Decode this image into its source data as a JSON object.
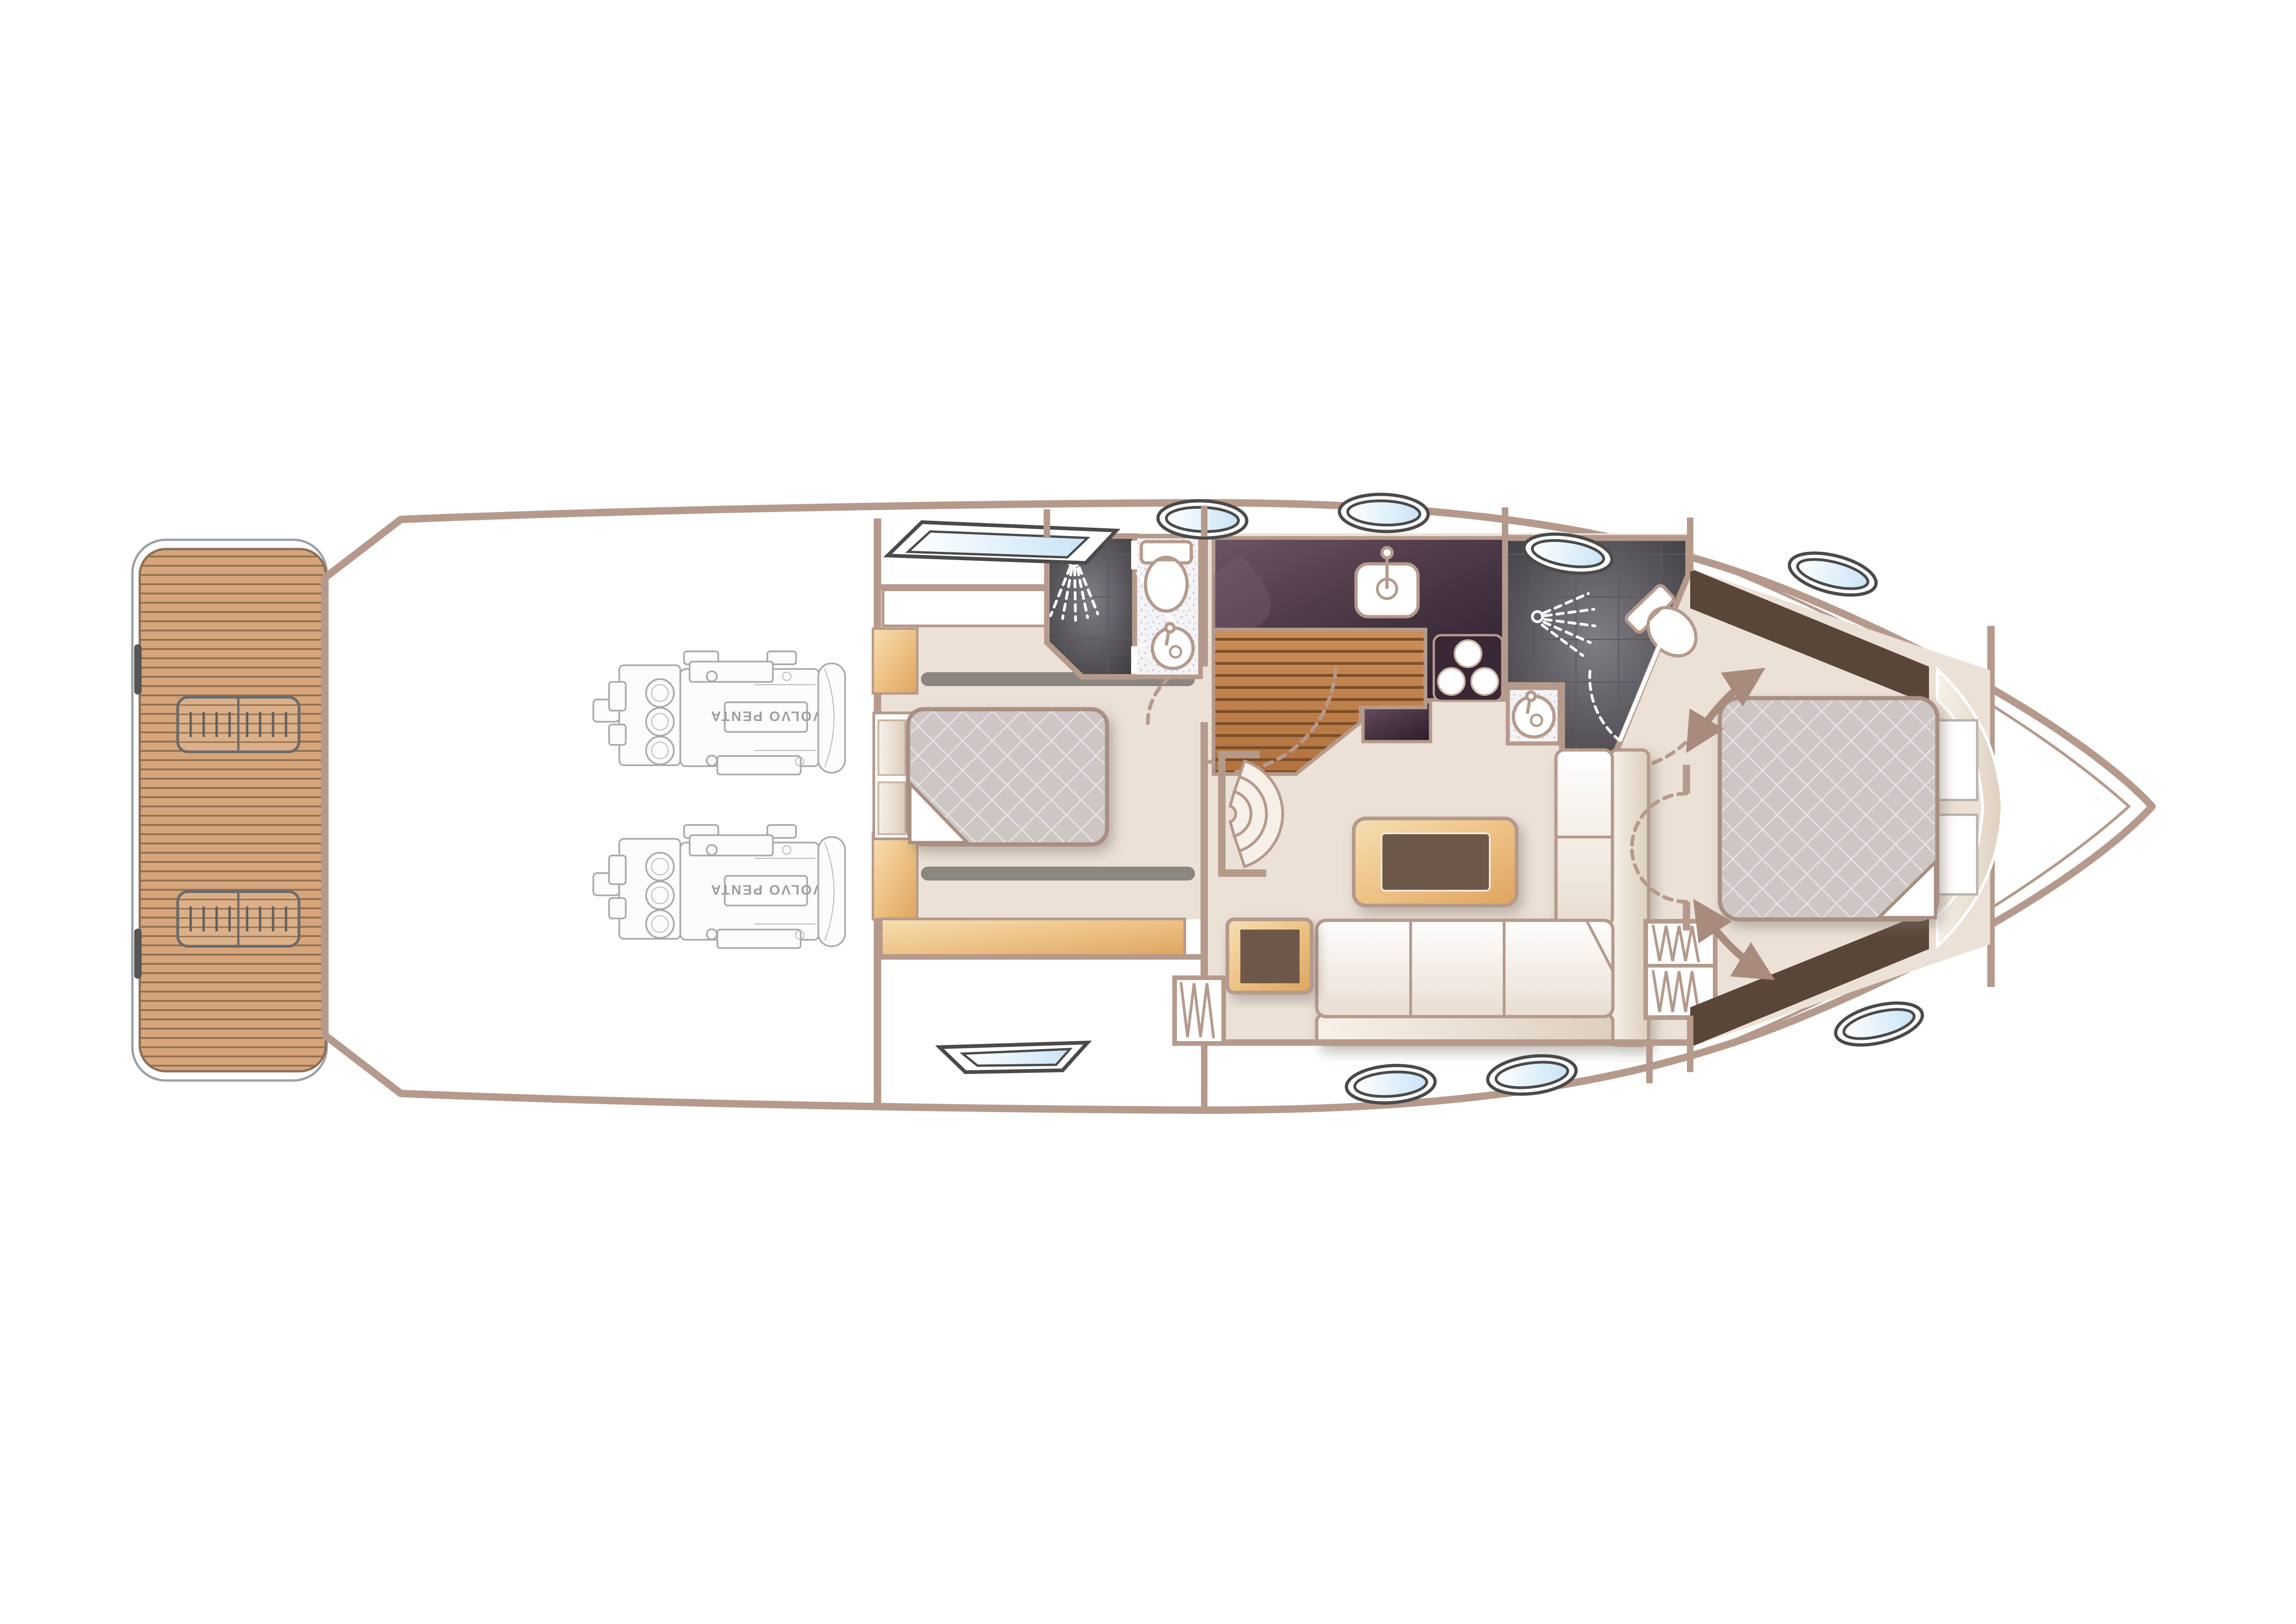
{
  "plan": {
    "view": "lower-deck-floor-plan",
    "engine_brand_label": "VOLVO PENTA",
    "engine_count": 2
  },
  "colors": {
    "hull_outline": "#b59a8c",
    "interior_floor": "#ece1d7",
    "teak_deck": "#d6a57c",
    "teak_plank_line": "#93714f",
    "galley_counter_dark": "#2f2130",
    "galley_counter_mid": "#4f3a49",
    "galley_counter_light": "#6d5465",
    "wet_room_tile_dark": "#39383c",
    "wet_room_tile_light": "#807d84",
    "tile_grout": "#5c5a5e",
    "wardrobe_brown": "#5a4639",
    "mattress_quilt": "#cdc6c4",
    "quilt_stitch": "#e8e4e3",
    "mattress_edge": "#a98f83",
    "wood_furniture_light": "#f6dfb2",
    "wood_furniture_dark": "#dda45e",
    "dark_wood_inset": "#6e5948",
    "galley_sole_light": "#cc8f58",
    "galley_sole_dark": "#b2713d",
    "glass_blue": "#c9e4f6",
    "porthole_ring": "#4a4a4a",
    "arrow": "#a98b7d",
    "sofa_cream": "#faf5ef",
    "track_grey": "#8b8680",
    "white": "#ffffff"
  },
  "icons": {
    "shower": "shower-spray-icon",
    "toilet": "toilet-icon",
    "basin": "round-basin-icon",
    "galley_sink": "sink-icon",
    "hob": "three-burner-hob-icon",
    "hangers": "hanging-locker-icon",
    "stairs": "curved-steps-icon",
    "door_swing": "door-swing-arc",
    "berth_slide": "double-headed-arrow-icon",
    "skylight": "skylight-icon",
    "porthole": "porthole-icon",
    "engine": "engine-line-art"
  }
}
